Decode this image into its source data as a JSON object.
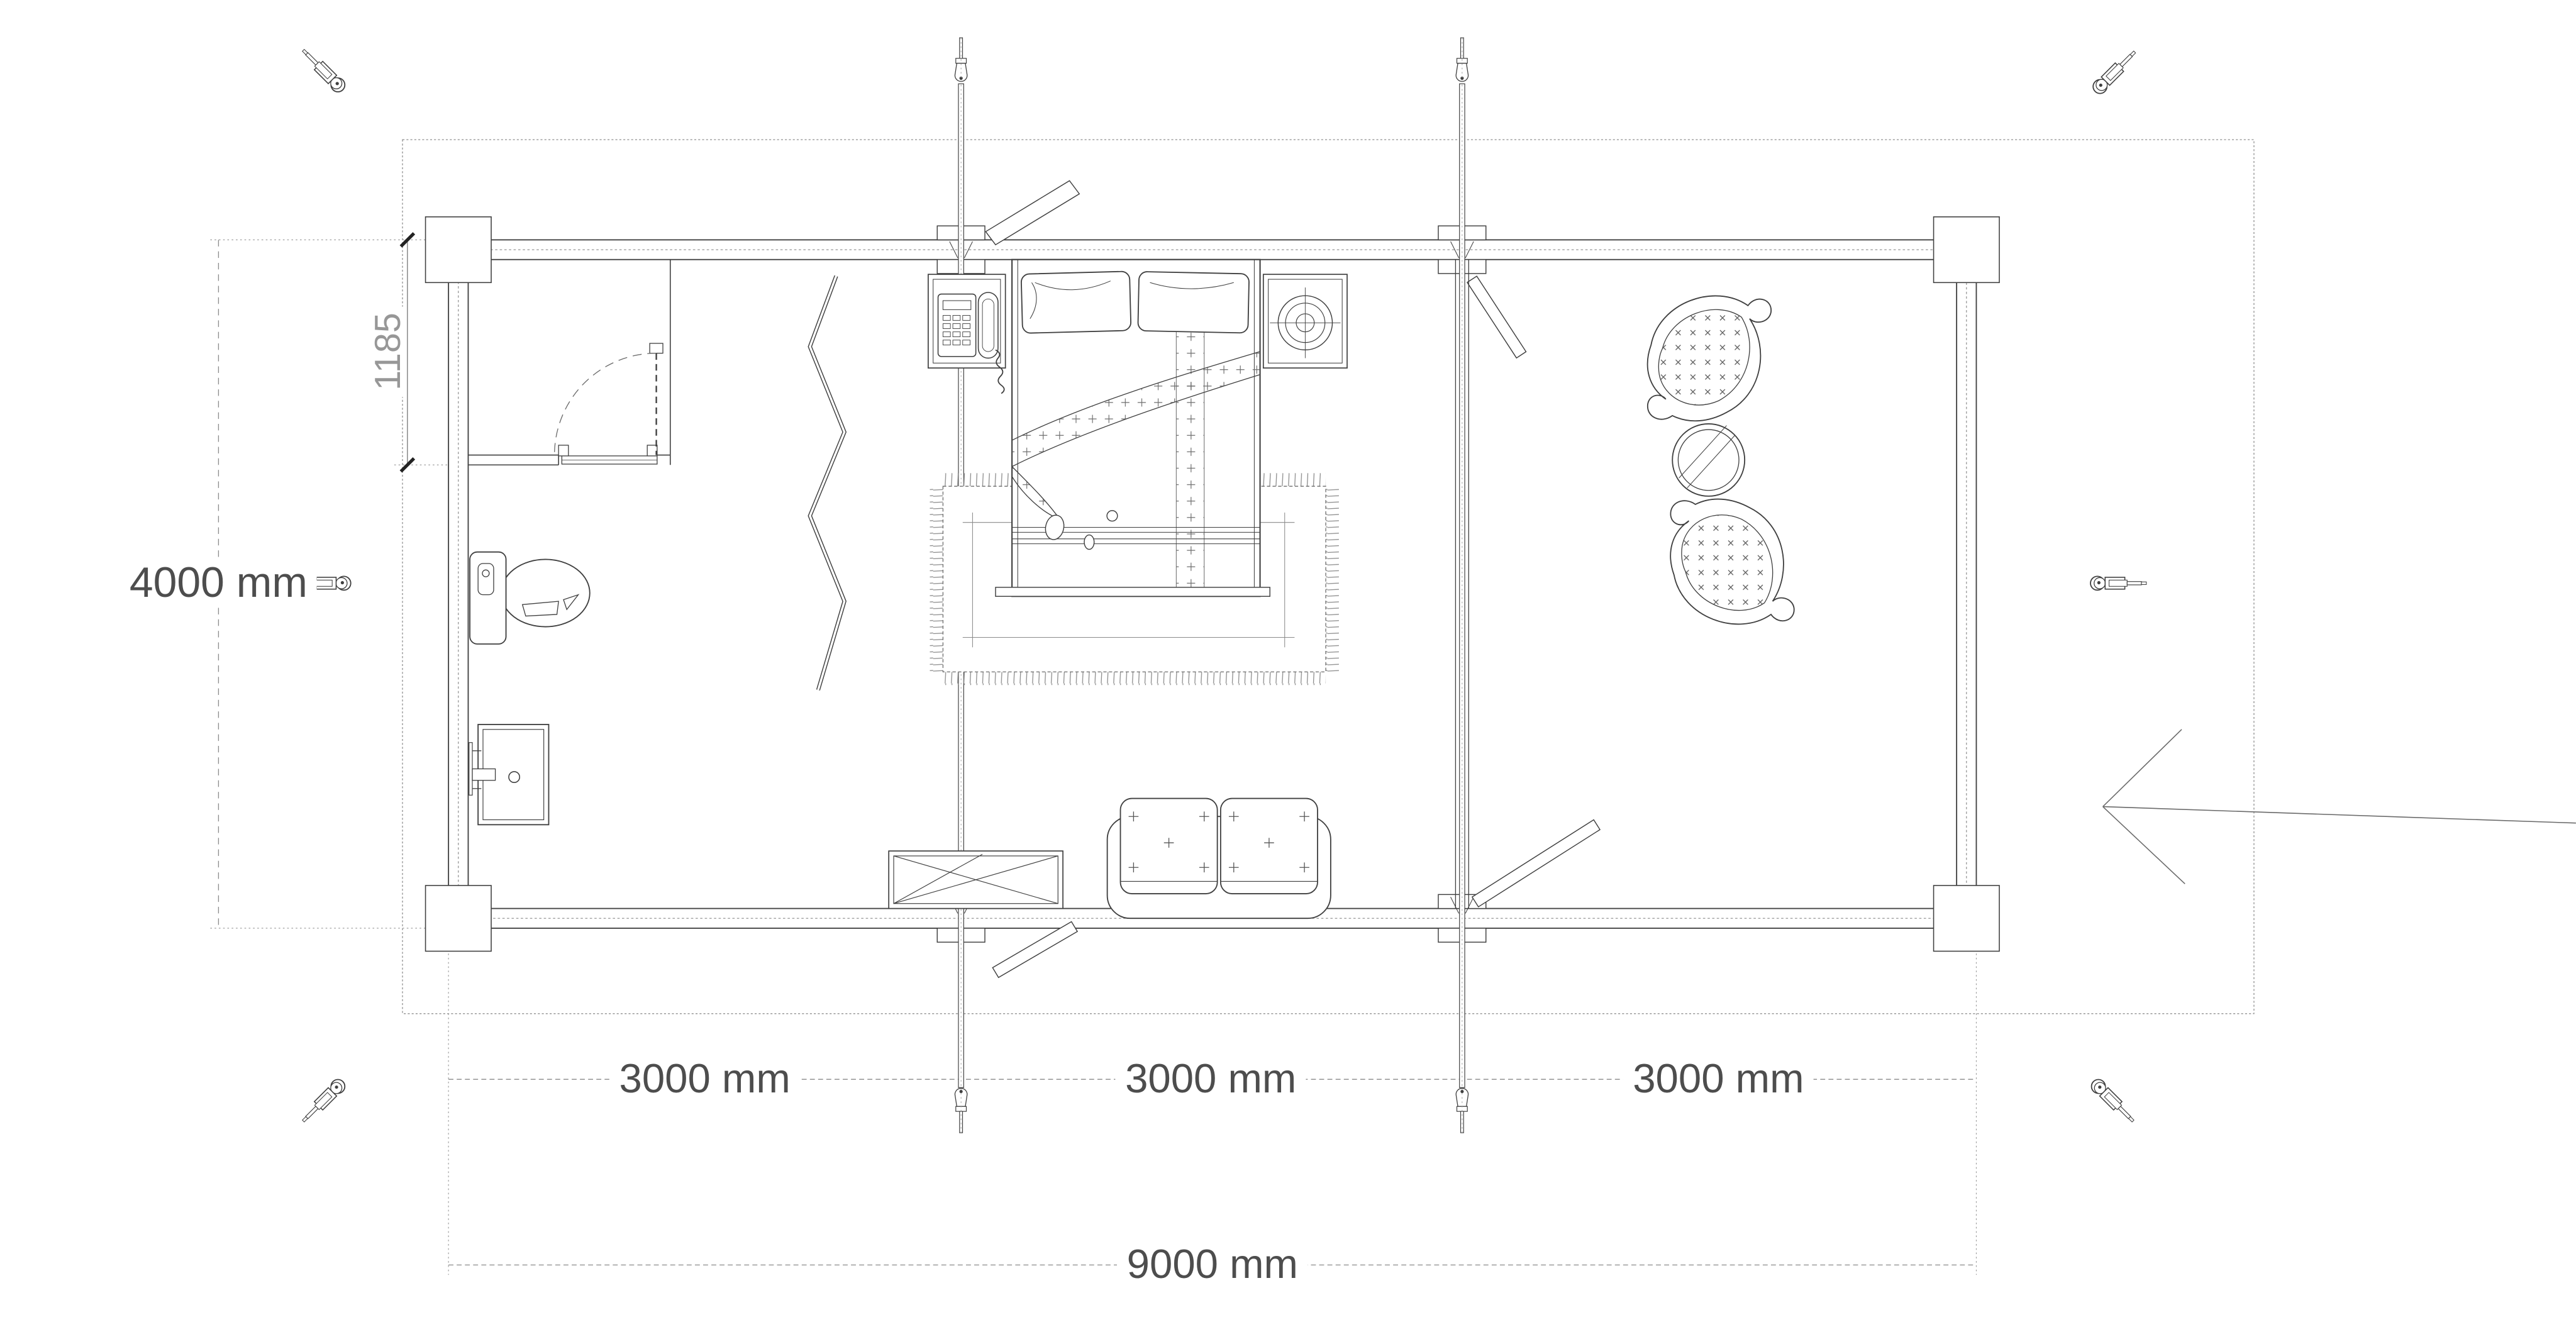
{
  "drawing": {
    "type": "log-cabin floor plan, top view",
    "labels": {
      "overall_width": "9000 mm",
      "overall_depth": "4000 mm",
      "bay1": "3000 mm",
      "bay2": "3000 mm",
      "bay3": "3000 mm",
      "bathroom_depth": "1185"
    },
    "rooms": [
      "entry-closet",
      "main-room",
      "lounge-room"
    ],
    "furniture": [
      "toilet",
      "washbasin",
      "folding-screen",
      "double-bed",
      "nightstand-with-telephone",
      "nightstand-with-lamp",
      "fringed-rug",
      "crossed-table",
      "two-seat-sofa",
      "paisley-armchair",
      "paisley-armchair",
      "round-glass-table"
    ],
    "hardware": [
      "storm-brace-rod-left",
      "storm-brace-rod-right",
      "turnbuckle-icon-corners",
      "turnbuckle-icon-sides"
    ],
    "colors": {
      "background": "#ffffff",
      "line": "#3f3f3f",
      "site_line": "#9a9a9a",
      "dim_line": "#8a8a8a",
      "dim_text": "#4d4d4d",
      "light_text": "#979797"
    }
  }
}
